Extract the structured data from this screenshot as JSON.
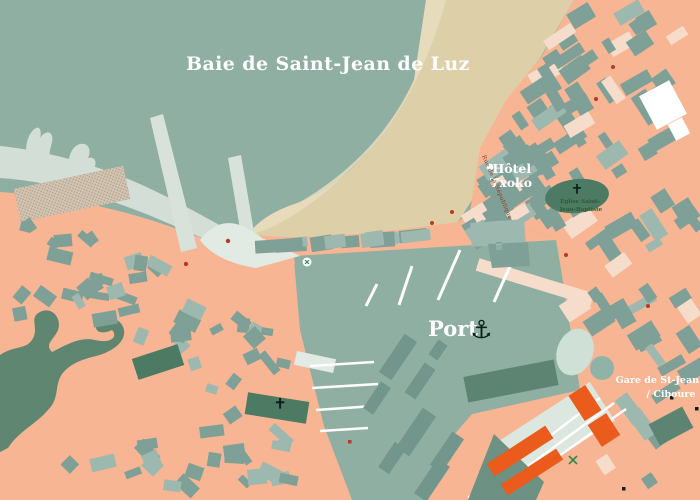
{
  "title": "Baie de Saint-Jean de Luz",
  "labels": {
    "port": "Port",
    "port_icon": "⚓",
    "hotel": {
      "line1": "Hôtel",
      "line2": "Txoko"
    },
    "street": "Rue de la République",
    "church": {
      "line1": "Église Saint-",
      "line2": "Jean-Baptiste"
    },
    "gare": {
      "line1": "Gare de St-Jean de",
      "line2": "/ Ciboure"
    }
  },
  "icons": {
    "port": "anchor-icon",
    "churches": "latin-cross-icon",
    "hotel_marker": "location-dot-icon",
    "poi": "poi-marker-icon"
  },
  "colors": {
    "sea": "#8EAFA2",
    "shore": "#D3DED7",
    "beach": "#DDD0A9",
    "beach_light": "#E8DDBE",
    "land": "#F8B594",
    "building": "#7FA097",
    "building_light": "#9DB8AE",
    "building_pale": "#F6DCCB",
    "building_dark": "#73968C",
    "pier": "#D8E2DB",
    "pier_light": "#E2EAE4",
    "park": "#5E8670",
    "park_light": "#CFE0D6",
    "park_mid": "#8FB3A6",
    "church": "#4C7A62",
    "quay_dark": "#5D8472",
    "wedge": "#6D9183",
    "orange": "#EB5B1C",
    "station": "#DCE7E0",
    "white": "#FFFFFF",
    "hatch_bg": "#DCC2AC",
    "hatch_dot": "#8FA9A0",
    "label_street": "#8A3A1E",
    "label_church": "#2F5A35",
    "icon_red": "#B43B26",
    "icon_green": "#2F8A46",
    "ink": "#0C211B"
  }
}
